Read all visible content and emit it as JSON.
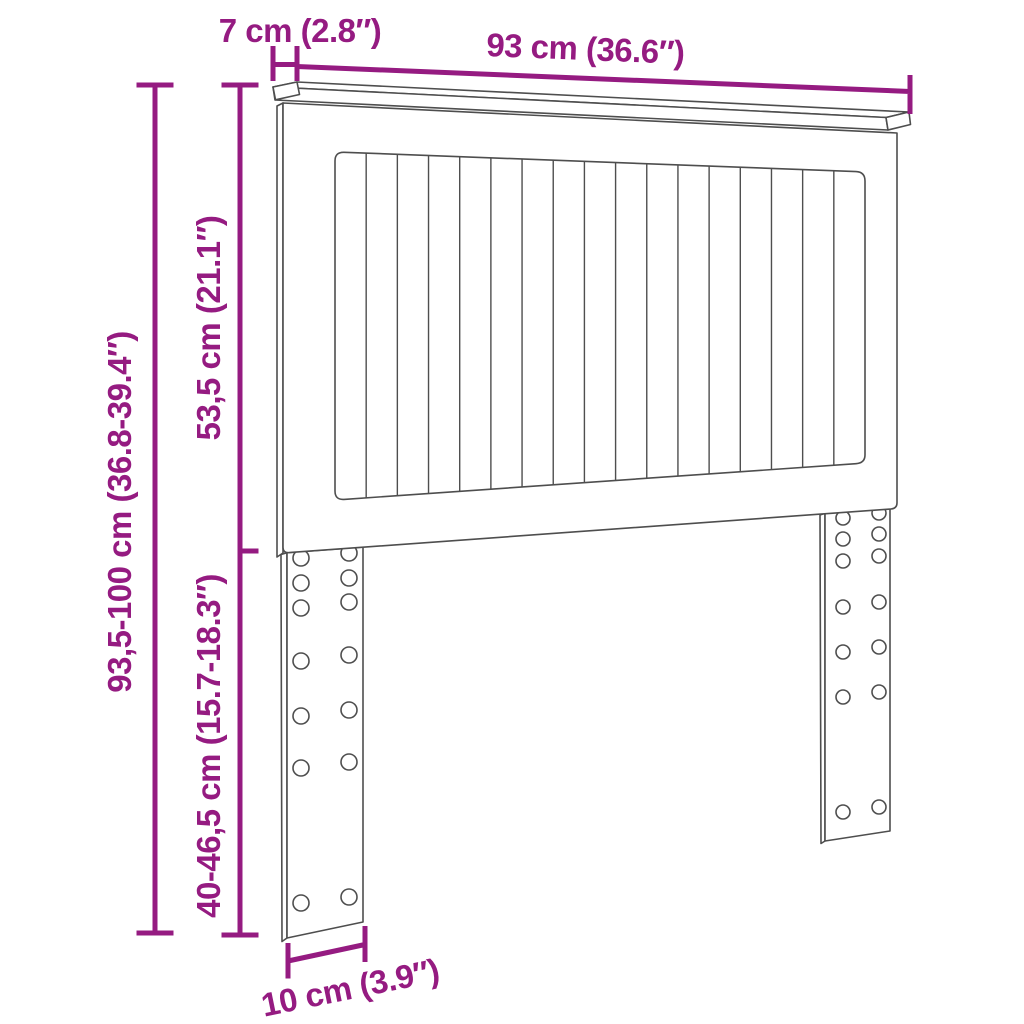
{
  "colors": {
    "accent": "#951b81",
    "outline": "#4e4e4e",
    "background": "#ffffff"
  },
  "labels": {
    "cap_depth": "7 cm (2.8″)",
    "cap_width": "93 cm (36.6″)",
    "total_height": "93,5-100 cm (36.8-39.4″)",
    "upper_height": "53,5 cm (21.1″)",
    "leg_height": "40-46,5 cm (15.7-18.3″)",
    "leg_width": "10 cm (3.9″)"
  },
  "drawing": {
    "slat_count": 17,
    "inner_panel": {
      "left": 335,
      "right": 865,
      "top_left_y": 152,
      "top_right_y": 172,
      "bottom_left_y": 500,
      "bottom_right_y": 463
    },
    "legs": [
      {
        "name": "left-leg",
        "hole_radius": 8,
        "columns": [
          {
            "x": 301,
            "rows": [
              558,
              583,
              608,
              661,
              716,
              768,
              903
            ]
          },
          {
            "x": 349,
            "rows": [
              553,
              578,
              602,
              655,
              710,
              762,
              897
            ]
          }
        ]
      },
      {
        "name": "right-leg",
        "hole_radius": 7,
        "columns": [
          {
            "x": 843,
            "rows": [
              518,
              539,
              561,
              607,
              652,
              697,
              812
            ]
          },
          {
            "x": 879,
            "rows": [
              513,
              534,
              556,
              602,
              647,
              692,
              807
            ]
          }
        ]
      }
    ]
  }
}
